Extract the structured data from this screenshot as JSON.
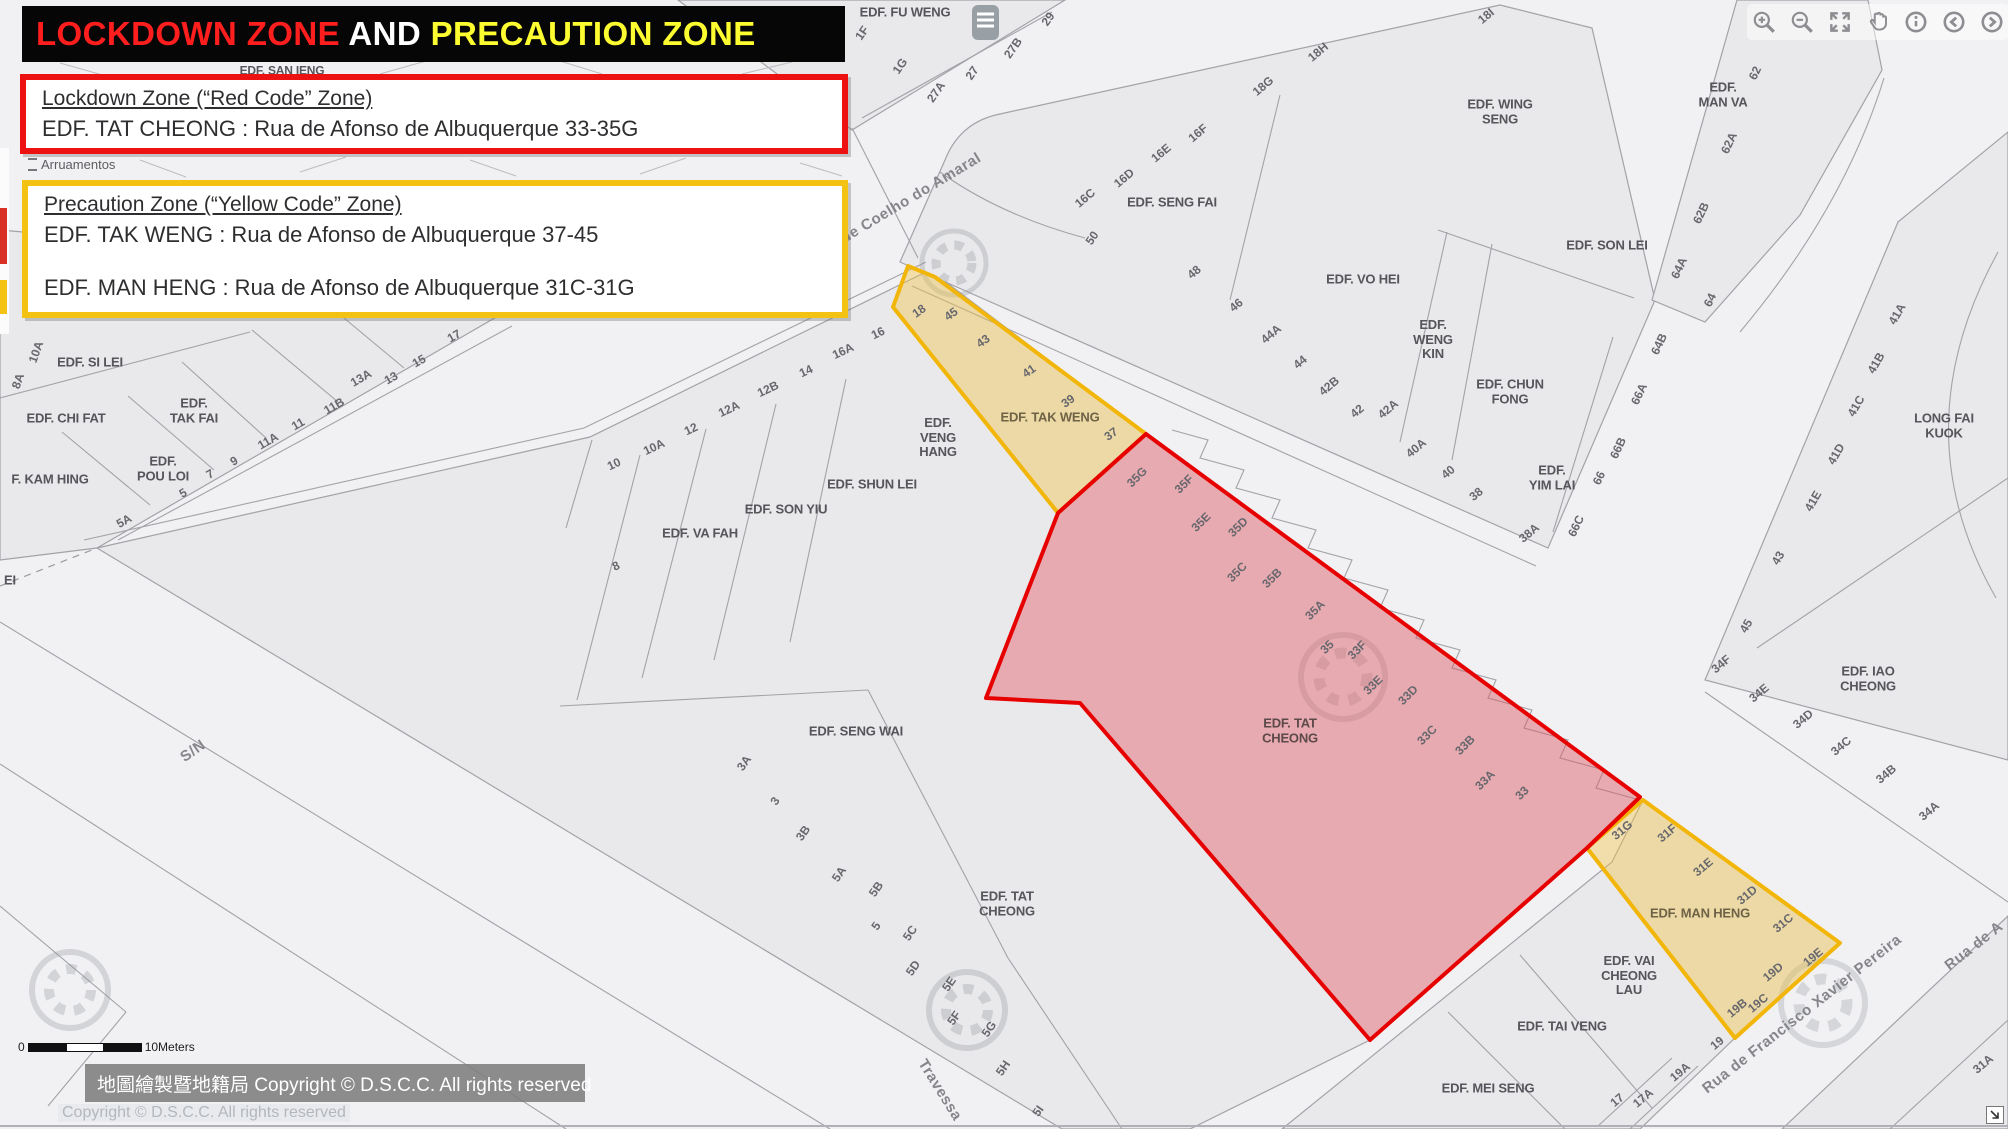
{
  "header": {
    "segments": [
      {
        "text": "LOCKDOWN ZONE",
        "color": "#ff1e1e"
      },
      {
        "text": " AND ",
        "color": "#ffffff"
      },
      {
        "text": "PRECAUTION ZONE",
        "color": "#fcfc30"
      }
    ]
  },
  "info_boxes": {
    "lockdown": {
      "title": "Lockdown Zone (“Red Code” Zone)",
      "line": "EDF. TAT CHEONG : Rua de Afonso de Albuquerque 33-35G"
    },
    "precaution": {
      "title": "Precaution Zone (“Yellow Code” Zone)",
      "lines": [
        "EDF. TAK WENG  : Rua de Afonso de Albuquerque 37-45",
        "EDF. MAN HENG  : Rua de Afonso de Albuquerque 31C-31G"
      ]
    }
  },
  "toolbar": {
    "buttons": [
      "zoom-in",
      "zoom-out",
      "full-extent",
      "pan",
      "info",
      "previous",
      "next"
    ]
  },
  "legend": {
    "item": "Arruamentos"
  },
  "scalebar": {
    "start": "0",
    "end": "10Meters"
  },
  "copyright": {
    "overlay": "地圖繪製暨地籍局 Copyright © D.S.C.C. All rights reserved",
    "underlay": "Copyright © D.S.C.C. All rights reserved"
  },
  "zones": {
    "lockdown": {
      "name": "Lockdown Zone (Red Code)",
      "building": "EDF. TAT CHEONG",
      "address": "Rua de Afonso de Albuquerque 33-35G",
      "stroke": "#e60000",
      "fill": "rgba(228,75,88,0.40)",
      "points": "1146,434 1640,797 1587,848 1370,1040 1080,703 986,698 1058,513"
    },
    "precaution_tak_weng": {
      "name": "Precaution Zone (Yellow Code)",
      "building": "EDF. TAK WENG",
      "address": "Rua de Afonso de Albuquerque 37-45",
      "stroke": "#f2b60a",
      "fill": "rgba(240,195,70,0.42)",
      "points": "893,307 908,266 935,277 1146,434 1058,513"
    },
    "precaution_man_heng": {
      "name": "Precaution Zone (Yellow Code)",
      "building": "EDF. MAN HENG",
      "address": "Rua de Afonso de Albuquerque 31C-31G",
      "stroke": "#f2b60a",
      "fill": "rgba(240,195,70,0.42)",
      "points": "1643,800 1840,943 1735,1038 1587,848"
    }
  },
  "map": {
    "building_labels": [
      {
        "text": "EDF. SAN IENG",
        "x": 282,
        "y": 71,
        "size": 12
      },
      {
        "text": "EDF. FU WENG",
        "x": 905,
        "y": 13
      },
      {
        "text": "EDF. WING\nSENG",
        "x": 1500,
        "y": 112
      },
      {
        "text": "EDF.\nMAN VA",
        "x": 1723,
        "y": 95
      },
      {
        "text": "EDF. SENG FAI",
        "x": 1172,
        "y": 203
      },
      {
        "text": "EDF. VO HEI",
        "x": 1363,
        "y": 280
      },
      {
        "text": "EDF. SON LEI",
        "x": 1607,
        "y": 246
      },
      {
        "text": "EDF.\nWENG\nKIN",
        "x": 1433,
        "y": 340
      },
      {
        "text": "EDF. CHUN\nFONG",
        "x": 1510,
        "y": 392
      },
      {
        "text": "EDF.\nYIM LAI",
        "x": 1552,
        "y": 478
      },
      {
        "text": "LONG FAI KUOK",
        "x": 1944,
        "y": 426
      },
      {
        "text": "EDF. IAO\nCHEONG",
        "x": 1868,
        "y": 679
      },
      {
        "text": "EDF. SI LEI",
        "x": 90,
        "y": 363
      },
      {
        "text": "EDF. CHI FAT",
        "x": 66,
        "y": 419
      },
      {
        "text": "EDF.\nTAK FAI",
        "x": 194,
        "y": 411
      },
      {
        "text": "EDF.\nPOU LOI",
        "x": 163,
        "y": 469
      },
      {
        "text": "F. KAM HING",
        "x": 50,
        "y": 480
      },
      {
        "text": "EI",
        "x": 10,
        "y": 581
      },
      {
        "text": "EDF. VA FAH",
        "x": 700,
        "y": 534
      },
      {
        "text": "EDF. SON YIU",
        "x": 786,
        "y": 510
      },
      {
        "text": "EDF. SHUN LEI",
        "x": 872,
        "y": 485
      },
      {
        "text": "EDF.\nVENG\nHANG",
        "x": 938,
        "y": 438
      },
      {
        "text": "EDF. TAK WENG",
        "x": 1050,
        "y": 418,
        "color": "#6e6347"
      },
      {
        "text": "EDF. SENG WAI",
        "x": 856,
        "y": 732
      },
      {
        "text": "EDF. TAT\nCHEONG",
        "x": 1290,
        "y": 731,
        "color": "#5c4a4a"
      },
      {
        "text": "EDF. TAT\nCHEONG",
        "x": 1007,
        "y": 904
      },
      {
        "text": "EDF. MAN HENG",
        "x": 1700,
        "y": 914,
        "color": "#6e6347"
      },
      {
        "text": "EDF. VAI\nCHEONG\nLAU",
        "x": 1629,
        "y": 976
      },
      {
        "text": "EDF. TAI VENG",
        "x": 1562,
        "y": 1027
      },
      {
        "text": "EDF. MEI SENG",
        "x": 1488,
        "y": 1089
      }
    ],
    "number_labels": [
      {
        "text": "1F",
        "x": 862,
        "y": 33,
        "rot": -55
      },
      {
        "text": "1G",
        "x": 900,
        "y": 66,
        "rot": -55
      },
      {
        "text": "27A",
        "x": 936,
        "y": 92,
        "rot": -55
      },
      {
        "text": "27",
        "x": 972,
        "y": 73,
        "rot": -55
      },
      {
        "text": "27B",
        "x": 1013,
        "y": 48,
        "rot": -55
      },
      {
        "text": "29",
        "x": 1048,
        "y": 19,
        "rot": -55
      },
      {
        "text": "16C",
        "x": 1085,
        "y": 198,
        "rot": -40
      },
      {
        "text": "16D",
        "x": 1124,
        "y": 178,
        "rot": -40
      },
      {
        "text": "16E",
        "x": 1161,
        "y": 153,
        "rot": -40
      },
      {
        "text": "16F",
        "x": 1198,
        "y": 133,
        "rot": -40
      },
      {
        "text": "50",
        "x": 1092,
        "y": 238,
        "rot": -55
      },
      {
        "text": "48",
        "x": 1194,
        "y": 272,
        "rot": -40
      },
      {
        "text": "46",
        "x": 1236,
        "y": 305,
        "rot": -40
      },
      {
        "text": "44A",
        "x": 1271,
        "y": 334,
        "rot": -40
      },
      {
        "text": "44",
        "x": 1300,
        "y": 362,
        "rot": -40
      },
      {
        "text": "42B",
        "x": 1329,
        "y": 386,
        "rot": -40
      },
      {
        "text": "42",
        "x": 1357,
        "y": 411,
        "rot": -40
      },
      {
        "text": "42A",
        "x": 1388,
        "y": 409,
        "rot": -40
      },
      {
        "text": "40A",
        "x": 1416,
        "y": 448,
        "rot": -40
      },
      {
        "text": "40",
        "x": 1448,
        "y": 472,
        "rot": -40
      },
      {
        "text": "38",
        "x": 1476,
        "y": 494,
        "rot": -40
      },
      {
        "text": "38A",
        "x": 1529,
        "y": 533,
        "rot": -40
      },
      {
        "text": "18G",
        "x": 1263,
        "y": 86,
        "rot": -40
      },
      {
        "text": "18H",
        "x": 1318,
        "y": 52,
        "rot": -40
      },
      {
        "text": "18I",
        "x": 1486,
        "y": 16,
        "rot": -40
      },
      {
        "text": "62",
        "x": 1755,
        "y": 73,
        "rot": -65
      },
      {
        "text": "62A",
        "x": 1729,
        "y": 143,
        "rot": -65
      },
      {
        "text": "62B",
        "x": 1701,
        "y": 213,
        "rot": -65
      },
      {
        "text": "64A",
        "x": 1679,
        "y": 268,
        "rot": -65
      },
      {
        "text": "64",
        "x": 1710,
        "y": 300,
        "rot": -65
      },
      {
        "text": "64B",
        "x": 1659,
        "y": 344,
        "rot": -65
      },
      {
        "text": "66A",
        "x": 1639,
        "y": 394,
        "rot": -65
      },
      {
        "text": "66B",
        "x": 1618,
        "y": 448,
        "rot": -65
      },
      {
        "text": "66",
        "x": 1599,
        "y": 478,
        "rot": -65
      },
      {
        "text": "66C",
        "x": 1576,
        "y": 526,
        "rot": -65
      },
      {
        "text": "8A",
        "x": 18,
        "y": 381,
        "rot": -70
      },
      {
        "text": "10A",
        "x": 36,
        "y": 352,
        "rot": -70
      },
      {
        "text": "5A",
        "x": 124,
        "y": 521,
        "rot": -30
      },
      {
        "text": "5",
        "x": 183,
        "y": 493,
        "rot": -30
      },
      {
        "text": "7",
        "x": 210,
        "y": 474,
        "rot": -30
      },
      {
        "text": "9",
        "x": 234,
        "y": 461,
        "rot": -30
      },
      {
        "text": "11A",
        "x": 268,
        "y": 441,
        "rot": -30
      },
      {
        "text": "11",
        "x": 298,
        "y": 424,
        "rot": -30
      },
      {
        "text": "11B",
        "x": 334,
        "y": 406,
        "rot": -30
      },
      {
        "text": "13A",
        "x": 361,
        "y": 378,
        "rot": -30
      },
      {
        "text": "13",
        "x": 391,
        "y": 378,
        "rot": -30
      },
      {
        "text": "15",
        "x": 419,
        "y": 361,
        "rot": -30
      },
      {
        "text": "17",
        "x": 454,
        "y": 336,
        "rot": -30
      },
      {
        "text": "10",
        "x": 614,
        "y": 464,
        "rot": -25
      },
      {
        "text": "10A",
        "x": 654,
        "y": 447,
        "rot": -25
      },
      {
        "text": "12",
        "x": 691,
        "y": 429,
        "rot": -25
      },
      {
        "text": "12A",
        "x": 729,
        "y": 409,
        "rot": -25
      },
      {
        "text": "12B",
        "x": 768,
        "y": 389,
        "rot": -25
      },
      {
        "text": "14",
        "x": 806,
        "y": 371,
        "rot": -25
      },
      {
        "text": "16A",
        "x": 843,
        "y": 351,
        "rot": -25
      },
      {
        "text": "16",
        "x": 878,
        "y": 333,
        "rot": -25
      },
      {
        "text": "8",
        "x": 616,
        "y": 566,
        "rot": -25
      },
      {
        "text": "18",
        "x": 919,
        "y": 311,
        "rot": -35
      },
      {
        "text": "45",
        "x": 951,
        "y": 314,
        "rot": -35
      },
      {
        "text": "43",
        "x": 983,
        "y": 341,
        "rot": -35
      },
      {
        "text": "41",
        "x": 1029,
        "y": 371,
        "rot": -35
      },
      {
        "text": "39",
        "x": 1068,
        "y": 401,
        "rot": -35
      },
      {
        "text": "37",
        "x": 1111,
        "y": 434,
        "rot": -35
      },
      {
        "text": "35G",
        "x": 1137,
        "y": 477,
        "rot": -45
      },
      {
        "text": "35F",
        "x": 1184,
        "y": 484,
        "rot": -45
      },
      {
        "text": "35E",
        "x": 1201,
        "y": 522,
        "rot": -45
      },
      {
        "text": "35D",
        "x": 1238,
        "y": 527,
        "rot": -45
      },
      {
        "text": "35C",
        "x": 1237,
        "y": 572,
        "rot": -45
      },
      {
        "text": "35B",
        "x": 1272,
        "y": 578,
        "rot": -45
      },
      {
        "text": "35A",
        "x": 1315,
        "y": 610,
        "rot": -45
      },
      {
        "text": "35",
        "x": 1327,
        "y": 647,
        "rot": -45
      },
      {
        "text": "33F",
        "x": 1357,
        "y": 650,
        "rot": -45
      },
      {
        "text": "33E",
        "x": 1373,
        "y": 685,
        "rot": -45
      },
      {
        "text": "33D",
        "x": 1408,
        "y": 695,
        "rot": -45
      },
      {
        "text": "33C",
        "x": 1427,
        "y": 735,
        "rot": -45
      },
      {
        "text": "33B",
        "x": 1465,
        "y": 745,
        "rot": -45
      },
      {
        "text": "33A",
        "x": 1485,
        "y": 780,
        "rot": -45
      },
      {
        "text": "33",
        "x": 1522,
        "y": 793,
        "rot": -45
      },
      {
        "text": "3A",
        "x": 744,
        "y": 763,
        "rot": -55
      },
      {
        "text": "3",
        "x": 775,
        "y": 801,
        "rot": -55
      },
      {
        "text": "3B",
        "x": 803,
        "y": 833,
        "rot": -55
      },
      {
        "text": "5A",
        "x": 839,
        "y": 874,
        "rot": -55
      },
      {
        "text": "5B",
        "x": 876,
        "y": 889,
        "rot": -55
      },
      {
        "text": "5",
        "x": 876,
        "y": 926,
        "rot": -55
      },
      {
        "text": "5C",
        "x": 910,
        "y": 933,
        "rot": -55
      },
      {
        "text": "5D",
        "x": 913,
        "y": 968,
        "rot": -55
      },
      {
        "text": "5E",
        "x": 949,
        "y": 984,
        "rot": -55
      },
      {
        "text": "5F",
        "x": 954,
        "y": 1018,
        "rot": -55
      },
      {
        "text": "5G",
        "x": 989,
        "y": 1029,
        "rot": -55
      },
      {
        "text": "5H",
        "x": 1003,
        "y": 1068,
        "rot": -55
      },
      {
        "text": "5I",
        "x": 1038,
        "y": 1111,
        "rot": -55
      },
      {
        "text": "41A",
        "x": 1897,
        "y": 314,
        "rot": -60
      },
      {
        "text": "41B",
        "x": 1876,
        "y": 363,
        "rot": -60
      },
      {
        "text": "41C",
        "x": 1856,
        "y": 406,
        "rot": -60
      },
      {
        "text": "41D",
        "x": 1836,
        "y": 454,
        "rot": -60
      },
      {
        "text": "41E",
        "x": 1813,
        "y": 501,
        "rot": -60
      },
      {
        "text": "43",
        "x": 1778,
        "y": 558,
        "rot": -60
      },
      {
        "text": "45",
        "x": 1746,
        "y": 626,
        "rot": -60
      },
      {
        "text": "34F",
        "x": 1721,
        "y": 664,
        "rot": -40
      },
      {
        "text": "34E",
        "x": 1759,
        "y": 693,
        "rot": -40
      },
      {
        "text": "34D",
        "x": 1803,
        "y": 719,
        "rot": -40
      },
      {
        "text": "34C",
        "x": 1841,
        "y": 746,
        "rot": -40
      },
      {
        "text": "34B",
        "x": 1886,
        "y": 774,
        "rot": -40
      },
      {
        "text": "34A",
        "x": 1929,
        "y": 811,
        "rot": -40
      },
      {
        "text": "31G",
        "x": 1622,
        "y": 830,
        "rot": -40
      },
      {
        "text": "31F",
        "x": 1667,
        "y": 833,
        "rot": -40
      },
      {
        "text": "31E",
        "x": 1703,
        "y": 867,
        "rot": -40
      },
      {
        "text": "31D",
        "x": 1747,
        "y": 895,
        "rot": -40
      },
      {
        "text": "31C",
        "x": 1783,
        "y": 923,
        "rot": -40
      },
      {
        "text": "19E",
        "x": 1813,
        "y": 957,
        "rot": -40
      },
      {
        "text": "19D",
        "x": 1773,
        "y": 972,
        "rot": -40
      },
      {
        "text": "19C",
        "x": 1758,
        "y": 1003,
        "rot": -40
      },
      {
        "text": "19B",
        "x": 1737,
        "y": 1008,
        "rot": -40
      },
      {
        "text": "19",
        "x": 1717,
        "y": 1043,
        "rot": -40
      },
      {
        "text": "19A",
        "x": 1680,
        "y": 1072,
        "rot": -40
      },
      {
        "text": "17A",
        "x": 1643,
        "y": 1098,
        "rot": -40
      },
      {
        "text": "17",
        "x": 1617,
        "y": 1100,
        "rot": -40
      },
      {
        "text": "31A",
        "x": 1983,
        "y": 1064,
        "rot": -40
      }
    ],
    "street_labels": [
      {
        "text": "de Coelho do Amaral",
        "x": 911,
        "y": 198,
        "rot": -31
      },
      {
        "text": "Travessa",
        "x": 940,
        "y": 1090,
        "rot": 58
      },
      {
        "text": "Rua de Francisco Xavier Pereira",
        "x": 1802,
        "y": 1014,
        "rot": -38
      },
      {
        "text": "Rua de A",
        "x": 1974,
        "y": 946,
        "rot": -38
      },
      {
        "text": "S/N",
        "x": 193,
        "y": 751,
        "rot": -35
      }
    ]
  }
}
